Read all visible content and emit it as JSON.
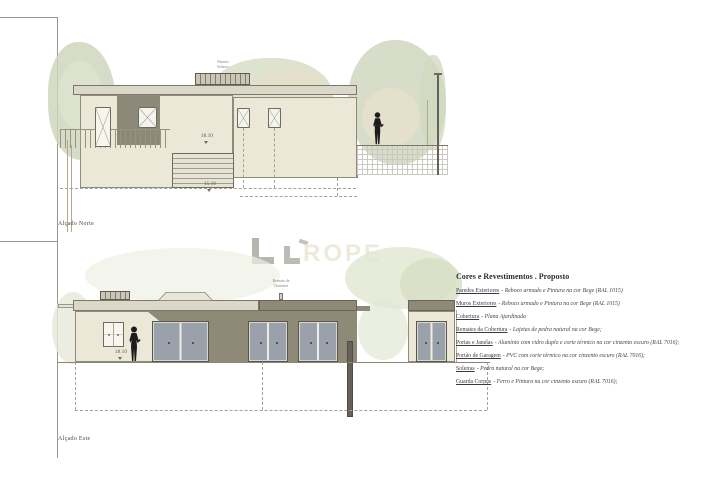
{
  "sheet": {
    "background": "#ffffff"
  },
  "elevations": {
    "north": {
      "label": "Alçado Norte",
      "levels": {
        "upper": "18.10",
        "lower": "15.10"
      },
      "roof_label": {
        "line1": "Paineis",
        "line2": "Solares"
      }
    },
    "east": {
      "label": "Alçado Este",
      "levels": {
        "ground": "18.10"
      },
      "roof_label": {
        "line1": "Remate de",
        "line2": "Chaminé"
      }
    }
  },
  "watermark": {
    "text": "ROPE"
  },
  "legend": {
    "title": "Cores e Revestimentos . Proposto",
    "items": [
      {
        "label": "Paredes Exteriores",
        "desc": "- Reboco armado e Pintura na cor Bege (RAL 1015)"
      },
      {
        "label": "Muros Exteriores",
        "desc": "- Reboco armado e Pintura na cor Bege (RAL 1015)"
      },
      {
        "label": "Cobertura",
        "desc": "- Plana Ajardinada"
      },
      {
        "label": "Remates da Cobertura",
        "desc": "- Lajetas de pedra natural na cor Bege;"
      },
      {
        "label": "Portas e Janelas",
        "desc": "- Alumínio com vidro duplo e corte térmico na cor cinzento escuro (RAL 7016);"
      },
      {
        "label": "Portão de Garagem",
        "desc": "- PVC com corte térmico na cor cinzento escuro (RAL 7016);"
      },
      {
        "label": "Soleiras",
        "desc": "- Pedra natural na cor Bege;"
      },
      {
        "label": "Guarda Corpos",
        "desc": "- Ferro e Pintura na cor cinzento escuro (RAL 7016);"
      }
    ]
  },
  "colors": {
    "wall_beige": "#ece8d8",
    "shadow_olive": "#8f8a78",
    "roof_gray": "#dcd8c9",
    "glass_gray": "#9aa1ab",
    "foliage_green": "#ced5bc",
    "foliage_tan": "#e3ddc6",
    "line": "#8a8677",
    "text_dark": "#3c3c48"
  }
}
